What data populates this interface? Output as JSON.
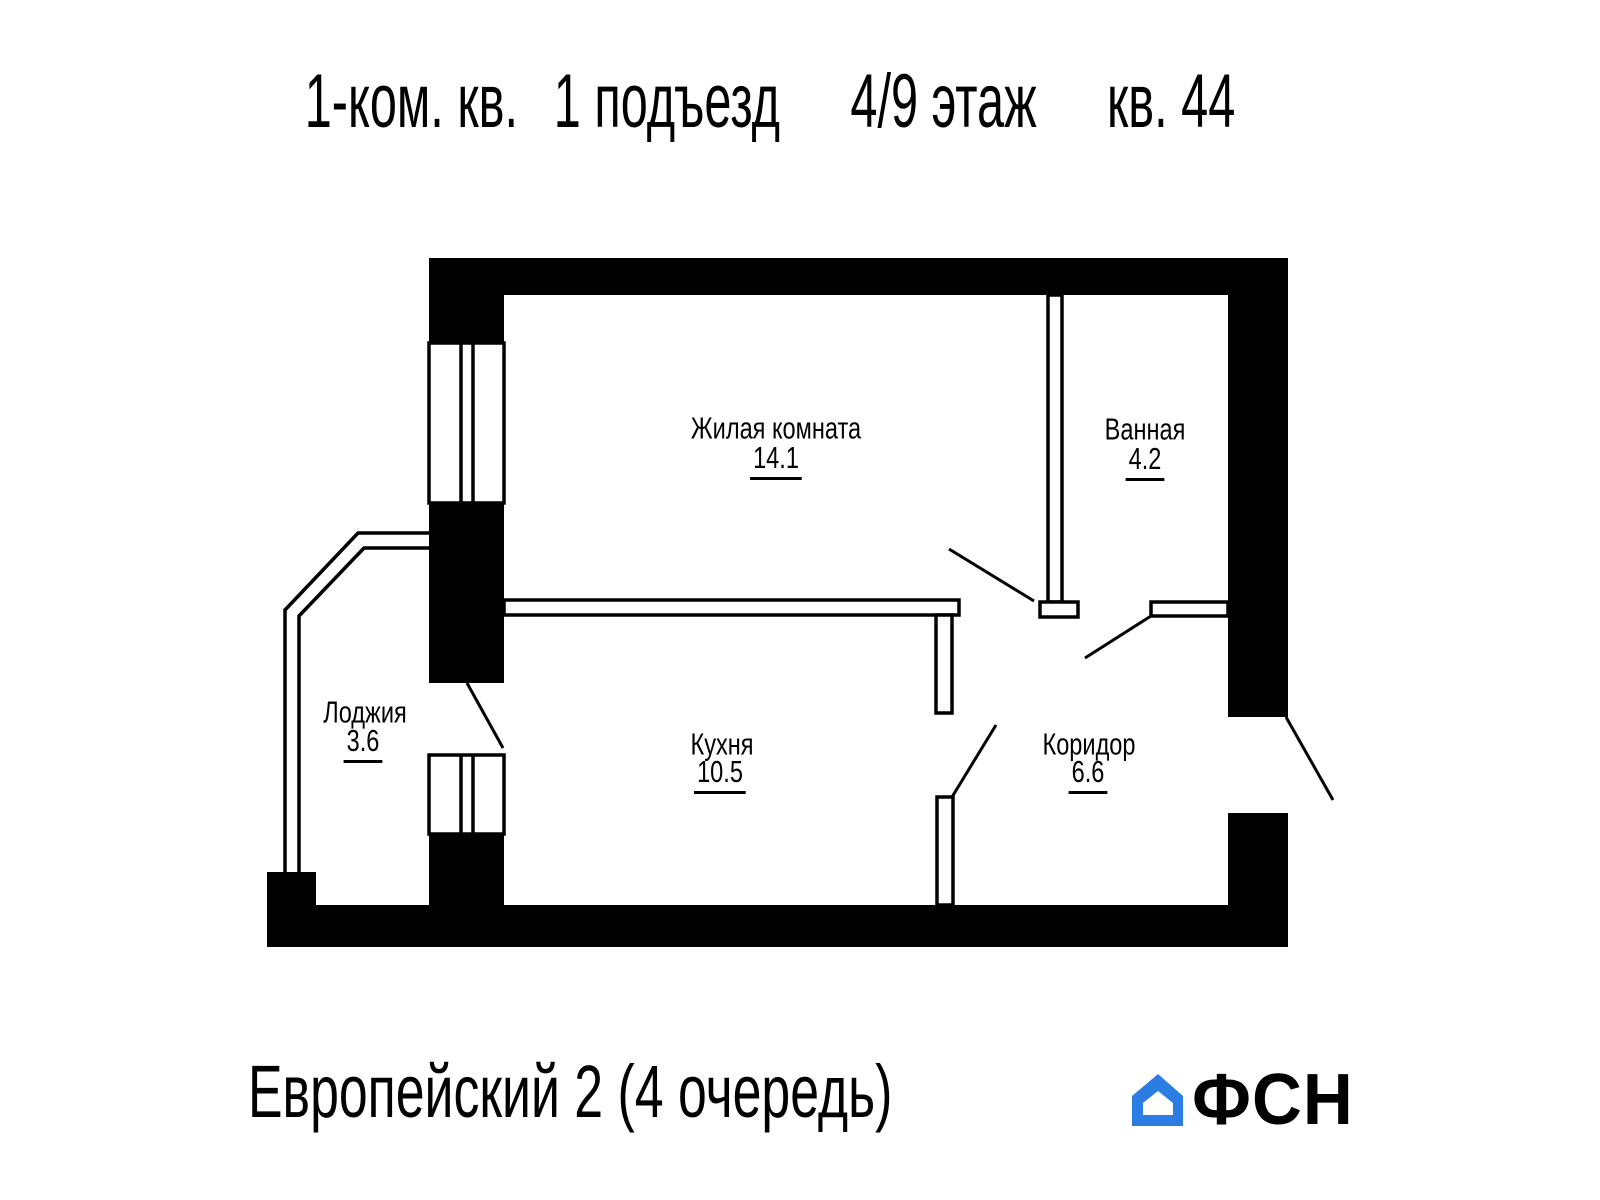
{
  "title": {
    "parts": [
      "1-ком. кв.",
      "1 подъезд",
      "4/9 этаж",
      "кв. 44"
    ]
  },
  "plan": {
    "rooms": [
      {
        "id": "living-room",
        "name": "Жилая комната",
        "area": "14.1"
      },
      {
        "id": "bathroom",
        "name": "Ванная",
        "area": "4.2"
      },
      {
        "id": "loggia",
        "name": "Лоджия",
        "area": "3.6"
      },
      {
        "id": "kitchen",
        "name": "Кухня",
        "area": "10.5"
      },
      {
        "id": "corridor",
        "name": "Коридор",
        "area": "6.6"
      }
    ]
  },
  "footer": {
    "project_name": "Европейский 2 (4 очередь)",
    "logo_text": "ФСН"
  },
  "colors": {
    "plan_ink": "#000000",
    "background": "#ffffff",
    "logo_blue": "#2b7de3",
    "logo_dark": "#1e2126"
  }
}
